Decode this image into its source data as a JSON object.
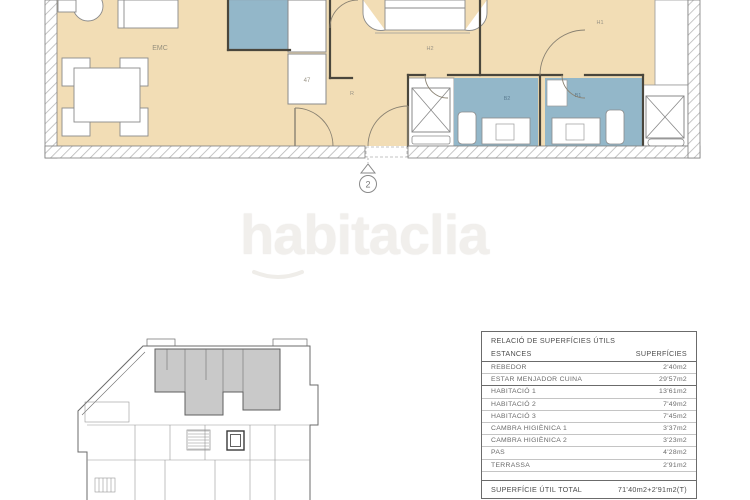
{
  "watermark": {
    "text": "habitaclia"
  },
  "floor_plan": {
    "room_labels": {
      "living": "EMC",
      "kitchen_unit": "47",
      "hall": "R",
      "bedroom_mid": "H2",
      "bedroom_right": "H1",
      "bath_left": "B2",
      "bath_right": "B1"
    },
    "unit_marker": "2"
  },
  "table": {
    "title": "RELACIÓ DE SUPERFÍCIES ÚTILS",
    "col_estances": "ESTANCES",
    "col_superficies": "SUPERFÍCIES",
    "rows": [
      {
        "name": "REBEDOR",
        "area": "2'40m2"
      },
      {
        "name": "ESTAR MENJADOR CUINA",
        "area": "29'57m2"
      },
      {
        "name": "HABITACIÓ 1",
        "area": "13'61m2"
      },
      {
        "name": "HABITACIÓ 2",
        "area": "7'49m2"
      },
      {
        "name": "HABITACIÓ 3",
        "area": "7'45m2"
      },
      {
        "name": "CAMBRA HIGIÈNICA 1",
        "area": "3'37m2"
      },
      {
        "name": "CAMBRA HIGIÈNICA 2",
        "area": "3'23m2"
      },
      {
        "name": "PAS",
        "area": "4'28m2"
      },
      {
        "name": "TERRASSA",
        "area": "2'91m2"
      }
    ],
    "total_label": "SUPERFÍCIE ÚTIL TOTAL",
    "total_value": "71'40m2+2'91m2(T)"
  },
  "colors": {
    "floor": "#f2ddb5",
    "wet_rooms": "#93b7c9",
    "wall": "#4a463c",
    "unit_highlight": "#c9c9c9"
  }
}
